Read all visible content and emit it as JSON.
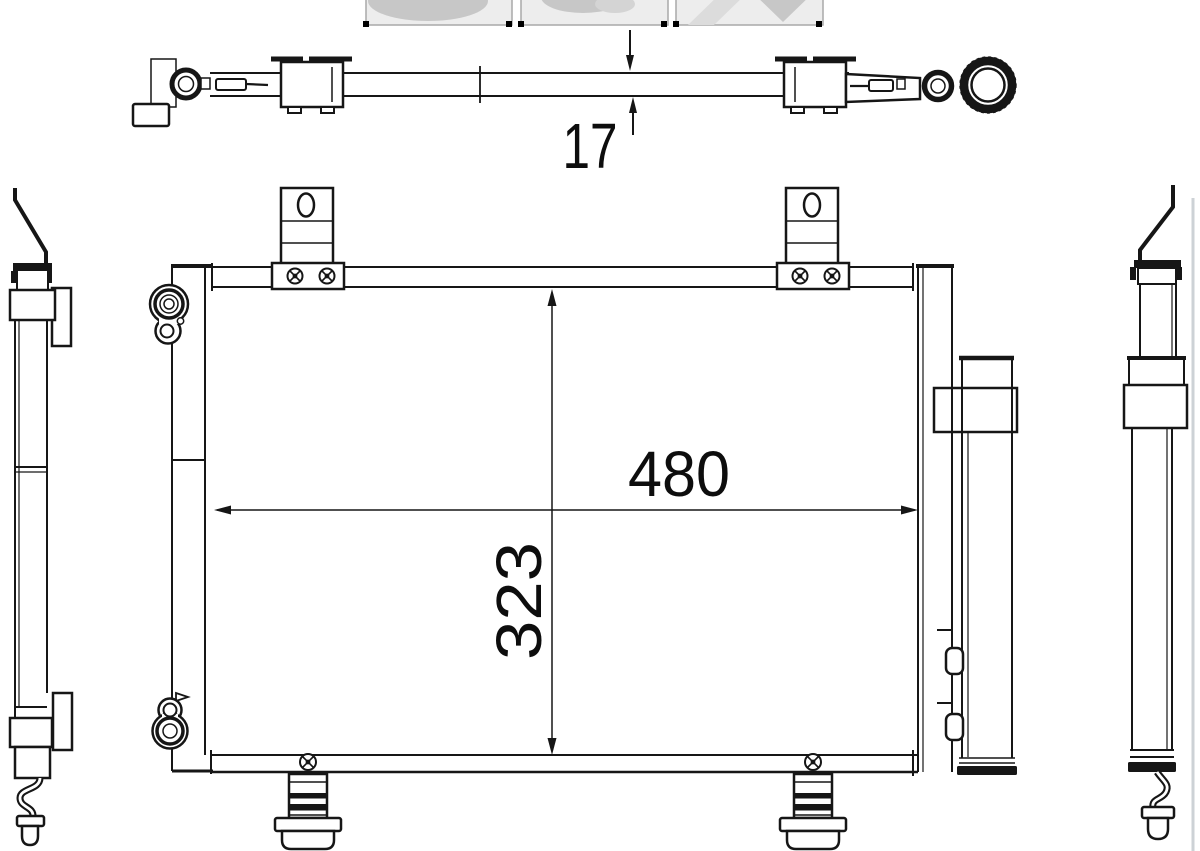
{
  "colors": {
    "background": "#ffffff",
    "line": "#161616",
    "thumbnail_fill": "#ededed",
    "thumbnail_border": "#a9a9a9",
    "thumbnail_blob": "#c7c7c7",
    "selection_handle": "#000000",
    "page_edge_line": "#cdd2d6"
  },
  "gallery": {
    "thumbnail_count": 3,
    "thumbnails": [
      {
        "name": "product-photo-thumbnail-1"
      },
      {
        "name": "product-photo-thumbnail-2"
      },
      {
        "name": "product-photo-thumbnail-3"
      }
    ]
  },
  "drawing": {
    "type": "technical-line-drawing",
    "views": [
      "top-view",
      "front-view",
      "left-side-view",
      "right-side-view"
    ],
    "dimensions": {
      "depth": {
        "value": "17"
      },
      "width": {
        "value": "480"
      },
      "height": {
        "value": "323"
      }
    }
  }
}
